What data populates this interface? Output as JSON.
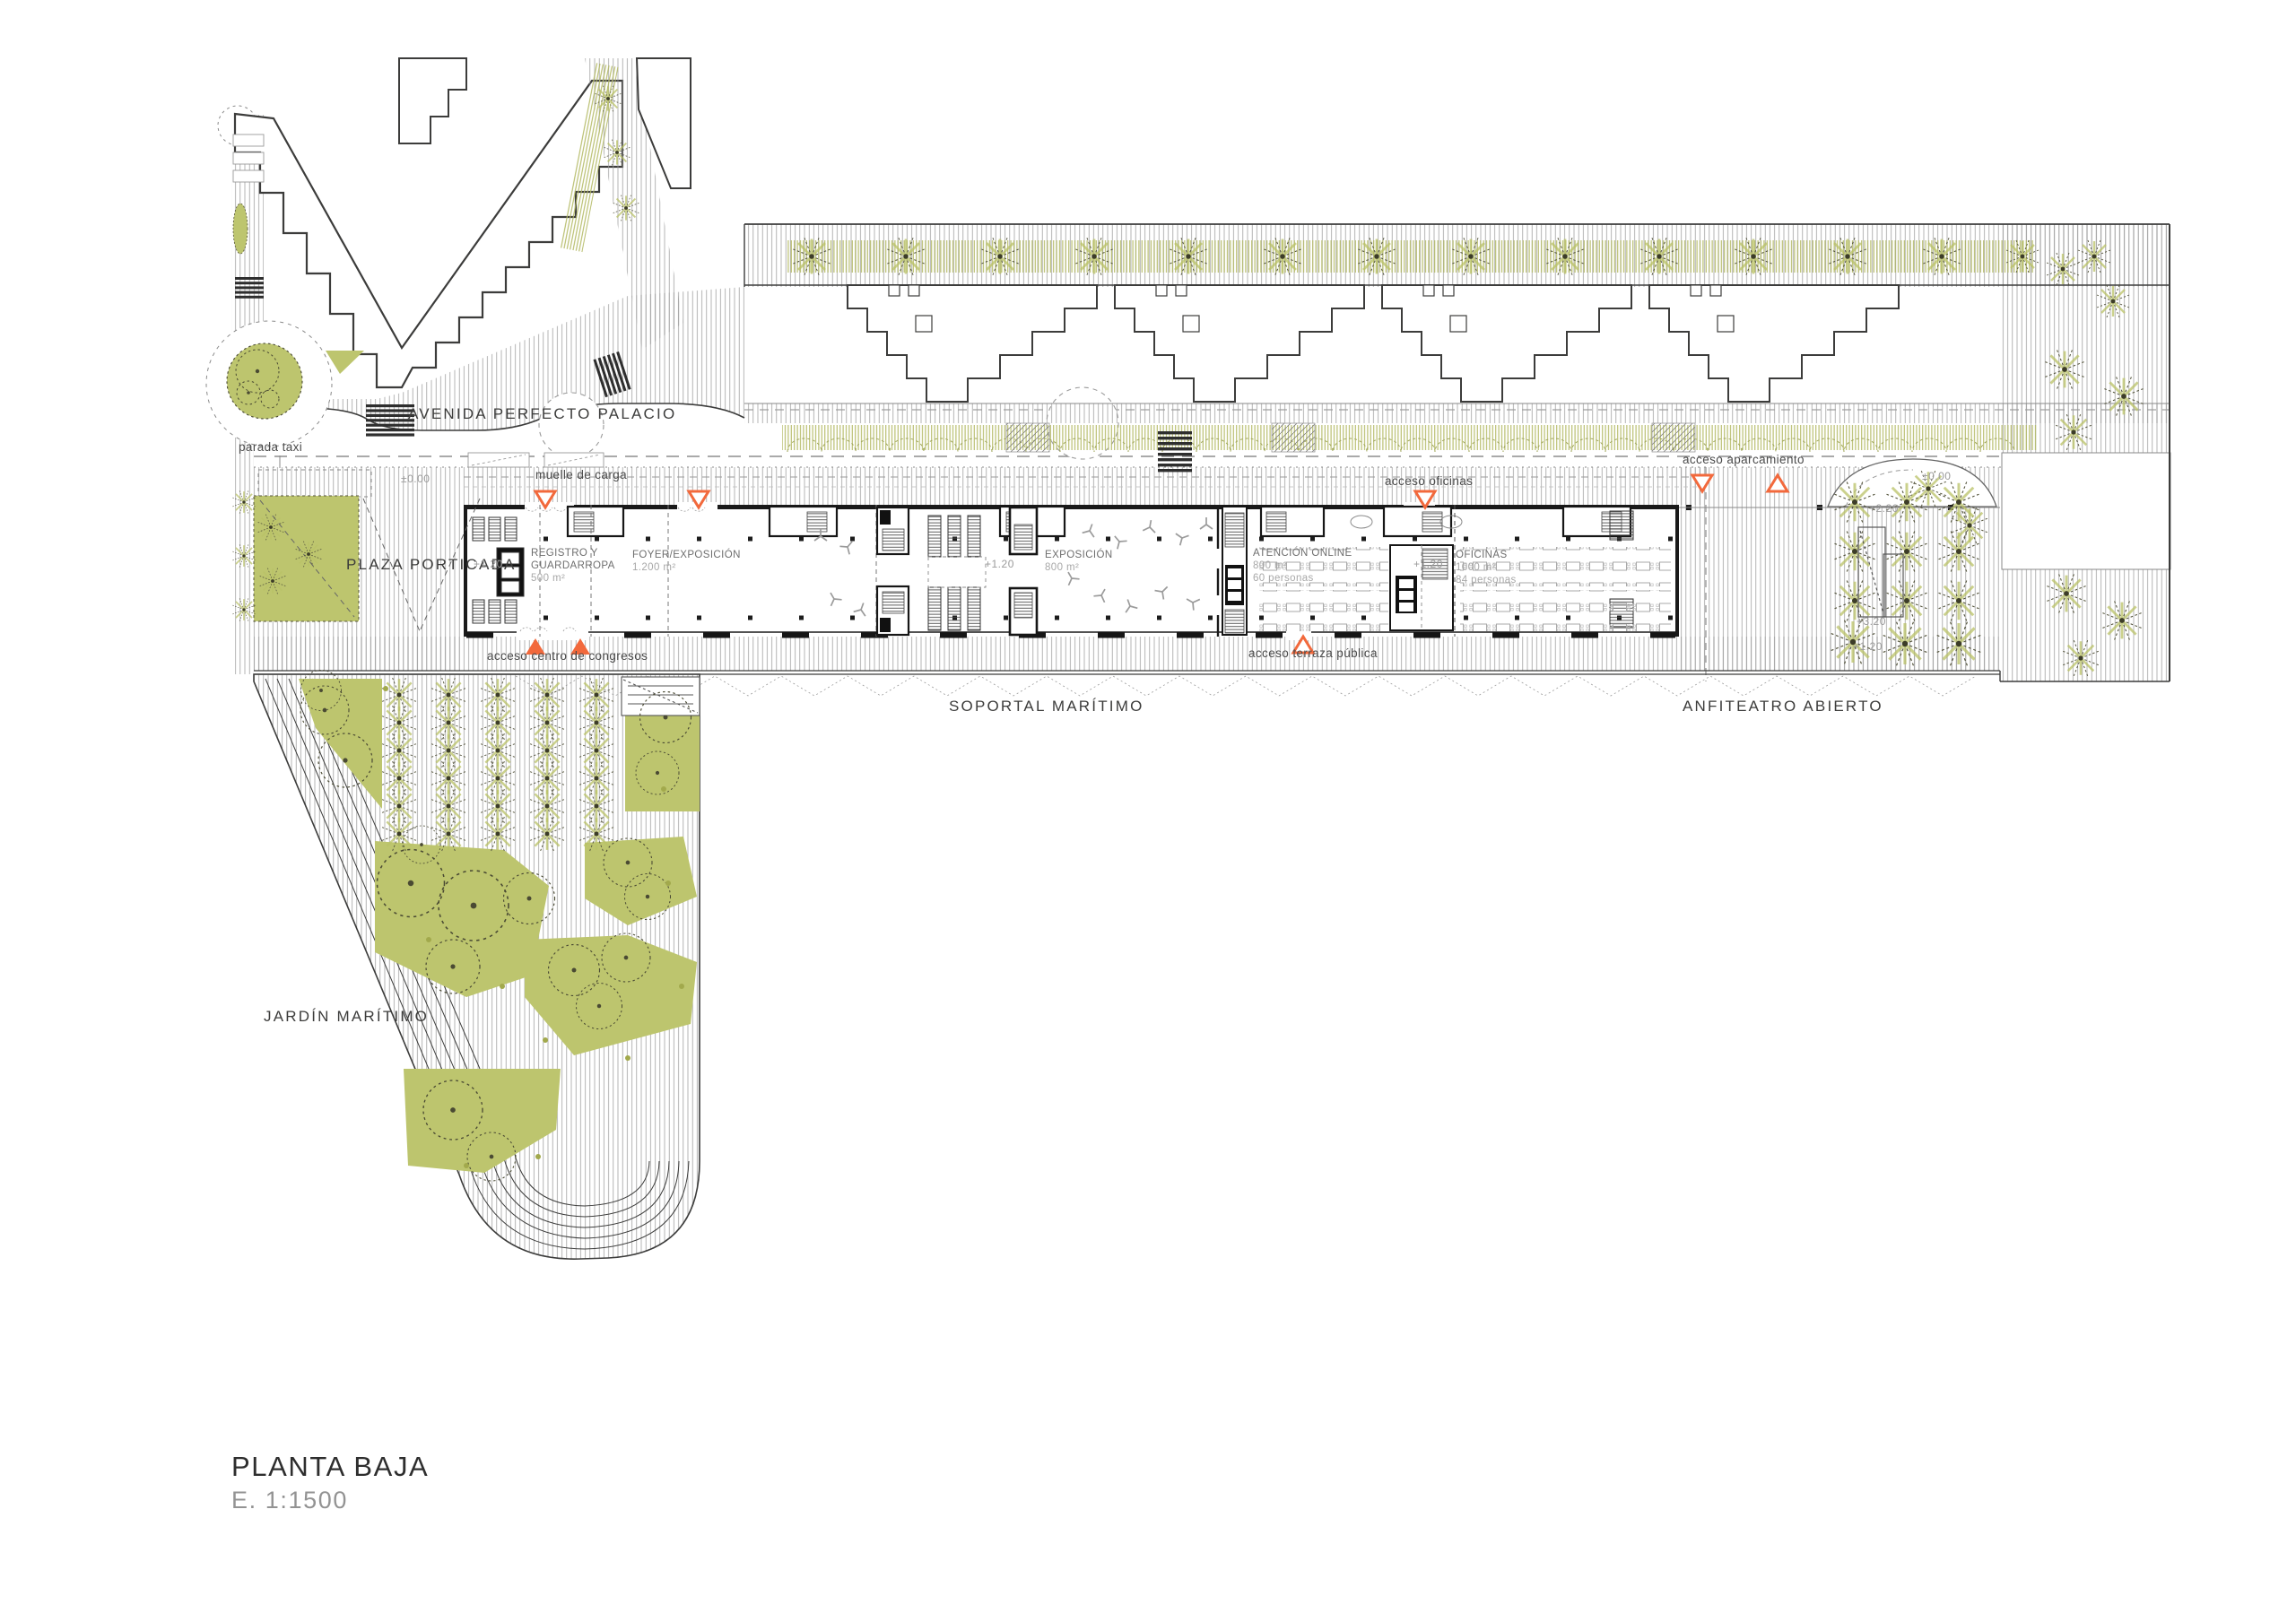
{
  "document": {
    "title": "PLANTA BAJA",
    "scale": "E. 1:1500"
  },
  "streets": {
    "avenue": "AVENIDA PERFECTO PALACIO",
    "taxi_stop": "parada taxi"
  },
  "places": {
    "plaza": "PLAZA PORTICADA",
    "soportal": "SOPORTAL MARÍTIMO",
    "amphitheater": "ANFITEATRO ABIERTO",
    "garden": "JARDÍN MARÍTIMO"
  },
  "accesses": {
    "loading_dock": "muelle de carga",
    "congress": "acceso centro de congresos",
    "offices": "acceso oficinas",
    "parking": "acceso aparcamiento",
    "public_terrace": "acceso terraza pública"
  },
  "rooms": {
    "registro": {
      "line1": "REGISTRO Y",
      "line2": "GUARDARROPA",
      "area": "500 m²"
    },
    "foyer": {
      "name": "FOYER/EXPOSICIÓN",
      "area": "1.200 m²"
    },
    "exposicion": {
      "name": "EXPOSICIÓN",
      "area": "800 m²"
    },
    "atencion": {
      "name": "ATENCIÓN ONLINE",
      "area": "800 m²",
      "capacity": "60 personas"
    },
    "oficinas": {
      "name": "OFICINAS",
      "area": "1000 m²",
      "capacity": "84 personas"
    }
  },
  "levels": {
    "ground": "±0.00",
    "l120": "+1.20",
    "l220": "+2.20",
    "l320": "+3.20"
  },
  "markers": {
    "entrance_filled_up": "▲",
    "entrance_open_up": "△",
    "entrance_open_down": "▽"
  },
  "colors": {
    "green": "#bdc56e",
    "green_line": "#a8ae56",
    "accent": "#f2693c",
    "line": "#3c3c3b",
    "hatch": "#8f8f8f",
    "text_gray": "#9b9b9b"
  }
}
